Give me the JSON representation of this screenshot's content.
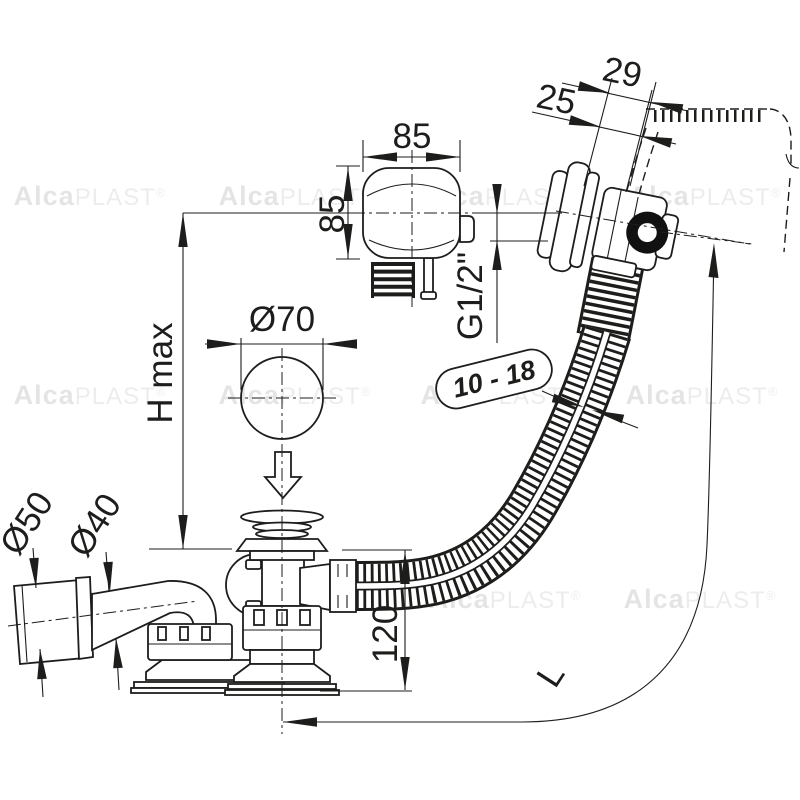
{
  "title": "Bath waste, overflow and filler set - technical dimension drawing",
  "watermark": {
    "bold": "Alca",
    "light": "PLAST",
    "reg": "®"
  },
  "dims": {
    "knob_width": "85",
    "knob_height": "85",
    "overflow_outer": "29",
    "overflow_inner": "25",
    "thread": "G1/2\"",
    "hole": "Ø70",
    "height_max": "H max",
    "wall_range": "10 - 18",
    "outlet_d50": "Ø50",
    "outlet_d40": "Ø40",
    "body_height": "120",
    "hose_length": "L"
  },
  "colors": {
    "line": "#1d1d1b",
    "background": "#ffffff",
    "oring": "#111111",
    "watermark": "#bdbdbd"
  }
}
